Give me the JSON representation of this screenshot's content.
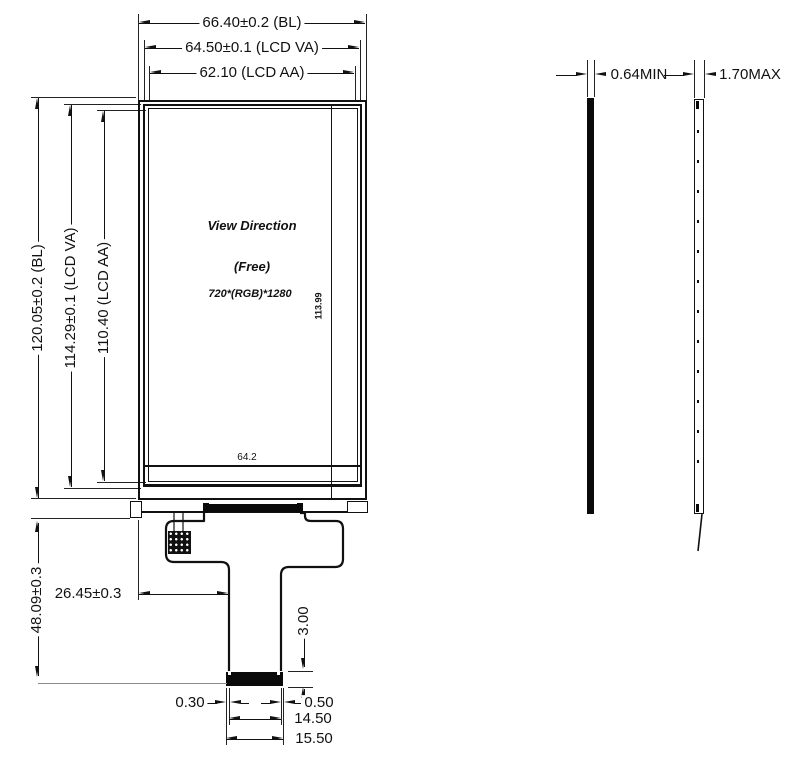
{
  "front_view": {
    "width_dims": [
      {
        "label": "66.40±0.2 (BL)"
      },
      {
        "label": "64.50±0.1 (LCD VA)"
      },
      {
        "label": "62.10 (LCD AA)"
      }
    ],
    "height_dims": [
      {
        "label": "120.05±0.2 (BL)"
      },
      {
        "label": "114.29±0.1 (LCD VA)"
      },
      {
        "label": "110.40 (LCD AA)"
      }
    ],
    "screen": {
      "view_direction": "View Direction",
      "mode": "(Free)",
      "resolution": "720*(RGB)*1280",
      "inner_width": "64.2",
      "inner_height": "113.99"
    },
    "fpc": {
      "length": "48.09±0.3",
      "offset_from_left": "26.45±0.3",
      "connector_height": "3.00",
      "left_margin": "0.30",
      "right_margin": "0.50",
      "connector_width": "14.50",
      "tail_width": "15.50"
    }
  },
  "side_views": {
    "panel_thickness": "0.64MIN",
    "module_thickness": "1.70MAX"
  },
  "colors": {
    "line": "#111111",
    "background": "#ffffff"
  }
}
